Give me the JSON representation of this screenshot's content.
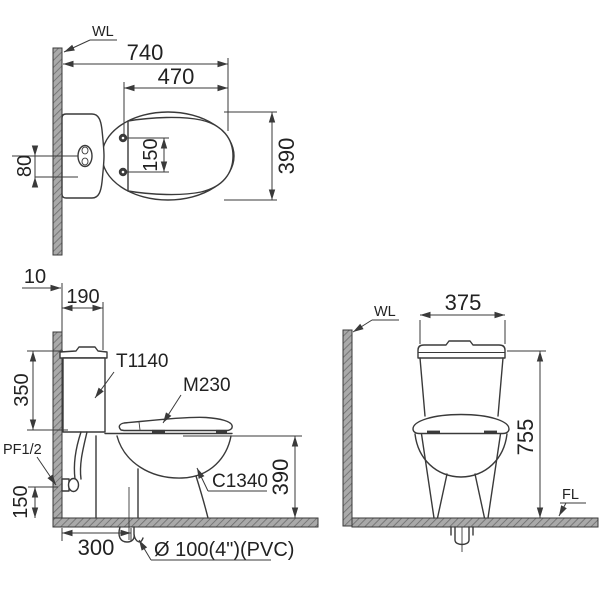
{
  "views": {
    "plan": {
      "wall_label": "WL",
      "dim_overall_length": "740",
      "dim_seat_length": "470",
      "dim_width": "390",
      "dim_hinge_spacing": "150",
      "dim_button_offset": "80"
    },
    "side": {
      "dim_wall_offset": "10",
      "dim_tank_depth": "190",
      "dim_tank_height": "350",
      "dim_inlet_height": "150",
      "dim_outlet_distance": "300",
      "dim_rim_height": "390",
      "label_tank": "T1140",
      "label_seat": "M230",
      "label_bowl": "C1340",
      "label_inlet": "PF1/2",
      "label_outlet": "Ø 100(4\")(PVC)"
    },
    "front": {
      "wall_label": "WL",
      "floor_label": "FL",
      "dim_tank_width": "375",
      "dim_overall_height": "755"
    }
  },
  "colors": {
    "line": "#3a3a3a",
    "text": "#222222",
    "wall_fill": "#a9a9a9",
    "wall_hatch": "#6b6b6b",
    "bg": "#ffffff"
  }
}
